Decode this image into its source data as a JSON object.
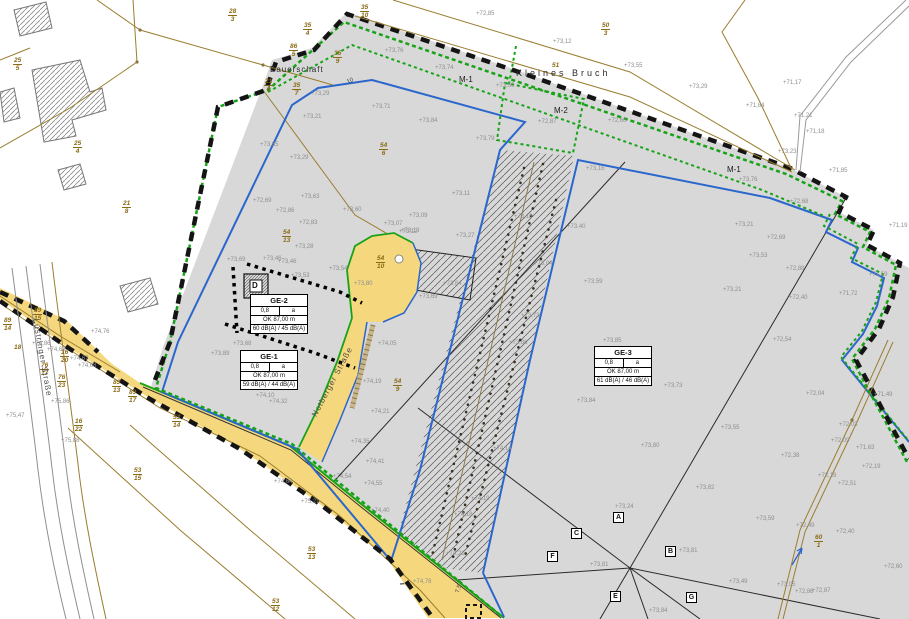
{
  "map": {
    "area_labels": [
      {
        "n": "kleines-bruch-label",
        "t": "Kleines Bruch",
        "x": 516,
        "y": 68,
        "cls": "area-label"
      },
      {
        "n": "bauerschaft-label",
        "t": "Bauerschaft",
        "x": 270,
        "y": 65,
        "cls": "area-label2"
      }
    ],
    "m_labels": [
      {
        "n": "m1-label-a",
        "t": "M-1",
        "x": 459,
        "y": 75
      },
      {
        "n": "m1-label-b",
        "t": "M-1",
        "x": 727,
        "y": 165
      },
      {
        "n": "m2-label",
        "t": "M-2",
        "x": 554,
        "y": 106
      }
    ],
    "streets": [
      {
        "n": "street-luestringer-strasse",
        "t": "Lüstringer Straße",
        "x": 40,
        "y": 318,
        "rot": 80
      },
      {
        "n": "street-notberger-strasse",
        "t": "Notberger Straße",
        "x": 310,
        "y": 414,
        "rot": -62
      }
    ],
    "zone_boxes": [
      {
        "id": "GE-2",
        "grz": "0,8",
        "bw": "a",
        "ok": "OK 87,00 m",
        "db": "60 dB(A) / 45 dB(A)",
        "x": 250,
        "y": 294
      },
      {
        "id": "GE-1",
        "grz": "0,8",
        "bw": "a",
        "ok": "OK 87,00 m",
        "db": "59 dB(A) / 44 dB(A)",
        "x": 240,
        "y": 350
      },
      {
        "id": "GE-3",
        "grz": "0,8",
        "bw": "a",
        "ok": "OK 87,00 m",
        "db": "61 dB(A) / 46 dB(A)",
        "x": 594,
        "y": 346
      }
    ],
    "d_marker": {
      "t": "D",
      "x": 252,
      "y": 281
    },
    "section_markers": [
      {
        "t": "A",
        "x": 613,
        "y": 512
      },
      {
        "t": "C",
        "x": 571,
        "y": 528
      },
      {
        "t": "F",
        "x": 547,
        "y": 551
      },
      {
        "t": "B",
        "x": 665,
        "y": 546
      },
      {
        "t": "E",
        "x": 610,
        "y": 591
      },
      {
        "t": "G",
        "x": 686,
        "y": 592
      }
    ],
    "dimensions": [
      {
        "n": "dim-7-5",
        "t": "7,5",
        "x": 455,
        "y": 592,
        "rot": -72
      },
      {
        "n": "dim-10",
        "t": "10",
        "x": 346,
        "y": 80,
        "rot": -25
      }
    ],
    "parcels": [
      {
        "num": "28",
        "den": "3",
        "x": 228,
        "y": 8
      },
      {
        "num": "35",
        "den": "4",
        "x": 303,
        "y": 22
      },
      {
        "num": "86",
        "den": "5",
        "x": 289,
        "y": 43
      },
      {
        "num": "25",
        "den": "5",
        "x": 13,
        "y": 57
      },
      {
        "num": "21",
        "den": "6",
        "x": 264,
        "y": 78
      },
      {
        "num": "35",
        "den": "7",
        "x": 292,
        "y": 82
      },
      {
        "num": "35",
        "den": "9",
        "x": 333,
        "y": 50
      },
      {
        "num": "35",
        "den": "10",
        "x": 360,
        "y": 4
      },
      {
        "num": "50",
        "den": "3",
        "x": 601,
        "y": 22
      },
      {
        "num": "25",
        "den": "4",
        "x": 73,
        "y": 140
      },
      {
        "num": "21",
        "den": "8",
        "x": 122,
        "y": 200
      },
      {
        "num": "54",
        "den": "6",
        "x": 379,
        "y": 142
      },
      {
        "num": "54",
        "den": "13",
        "x": 282,
        "y": 229
      },
      {
        "num": "54",
        "den": "10",
        "x": 376,
        "y": 255
      },
      {
        "num": "54",
        "den": "9",
        "x": 393,
        "y": 378
      },
      {
        "num": "54",
        "den": "11",
        "x": 609,
        "y": 370
      },
      {
        "num": "89",
        "den": "15",
        "x": 33,
        "y": 307
      },
      {
        "num": "89",
        "den": "14",
        "x": 3,
        "y": 317
      },
      {
        "num": "76",
        "den": "17",
        "x": 40,
        "y": 362
      },
      {
        "num": "76",
        "den": "23",
        "x": 57,
        "y": 374
      },
      {
        "num": "16",
        "den": "20",
        "x": 60,
        "y": 349
      },
      {
        "num": "16",
        "den": "22",
        "x": 74,
        "y": 418
      },
      {
        "num": "89",
        "den": "13",
        "x": 112,
        "y": 379
      },
      {
        "num": "89",
        "den": "17",
        "x": 128,
        "y": 389
      },
      {
        "num": "53",
        "den": "14",
        "x": 172,
        "y": 414
      },
      {
        "num": "53",
        "den": "15",
        "x": 133,
        "y": 467
      },
      {
        "num": "53",
        "den": "13",
        "x": 307,
        "y": 546
      },
      {
        "num": "53",
        "den": "12",
        "x": 271,
        "y": 598
      },
      {
        "num": "60",
        "den": "1",
        "x": 814,
        "y": 534
      }
    ],
    "parcels_single": [
      {
        "t": "51",
        "x": 552,
        "y": 62
      },
      {
        "t": "18",
        "x": 14,
        "y": 344
      }
    ],
    "elevations": [
      {
        "t": "+72,85",
        "x": 476,
        "y": 11
      },
      {
        "t": "+73,12",
        "x": 553,
        "y": 39
      },
      {
        "t": "+73,76",
        "x": 385,
        "y": 48
      },
      {
        "t": "+73,74",
        "x": 435,
        "y": 65
      },
      {
        "t": "+73,60",
        "x": 496,
        "y": 83
      },
      {
        "t": "+73,71",
        "x": 372,
        "y": 104
      },
      {
        "t": "+73,84",
        "x": 419,
        "y": 118
      },
      {
        "t": "+73,79",
        "x": 476,
        "y": 136
      },
      {
        "t": "+73,29",
        "x": 311,
        "y": 91
      },
      {
        "t": "+73,21",
        "x": 303,
        "y": 114
      },
      {
        "t": "+72,60",
        "x": 608,
        "y": 118
      },
      {
        "t": "+72,87",
        "x": 538,
        "y": 119
      },
      {
        "t": "+73,16",
        "x": 586,
        "y": 166
      },
      {
        "t": "+73,11",
        "x": 452,
        "y": 191
      },
      {
        "t": "+73,27",
        "x": 456,
        "y": 233
      },
      {
        "t": "+73,40",
        "x": 567,
        "y": 224
      },
      {
        "t": "+73,09",
        "x": 409,
        "y": 213
      },
      {
        "t": "+73,13",
        "x": 401,
        "y": 228
      },
      {
        "t": "+73,18",
        "x": 514,
        "y": 214
      },
      {
        "t": "+73,59",
        "x": 584,
        "y": 279
      },
      {
        "t": "+73,04",
        "x": 534,
        "y": 261
      },
      {
        "t": "+73,84",
        "x": 443,
        "y": 281
      },
      {
        "t": "+73,69",
        "x": 419,
        "y": 294
      },
      {
        "t": "+73,73",
        "x": 521,
        "y": 313
      },
      {
        "t": "+73,86",
        "x": 509,
        "y": 340
      },
      {
        "t": "+73,63",
        "x": 301,
        "y": 194
      },
      {
        "t": "+72,86",
        "x": 276,
        "y": 208
      },
      {
        "t": "+73,60",
        "x": 343,
        "y": 207
      },
      {
        "t": "+72,83",
        "x": 299,
        "y": 220
      },
      {
        "t": "+73,07",
        "x": 384,
        "y": 221
      },
      {
        "t": "+73,12",
        "x": 399,
        "y": 229
      },
      {
        "t": "+73,28",
        "x": 295,
        "y": 244
      },
      {
        "t": "+73,46",
        "x": 278,
        "y": 259
      },
      {
        "t": "+73,53",
        "x": 291,
        "y": 273
      },
      {
        "t": "+73,54",
        "x": 329,
        "y": 266
      },
      {
        "t": "+73,80",
        "x": 354,
        "y": 281
      },
      {
        "t": "+73,69",
        "x": 227,
        "y": 257
      },
      {
        "t": "+73,46",
        "x": 263,
        "y": 256
      },
      {
        "t": "+73,68",
        "x": 233,
        "y": 341
      },
      {
        "t": "+73,89",
        "x": 211,
        "y": 351
      },
      {
        "t": "+74,10",
        "x": 256,
        "y": 393
      },
      {
        "t": "+74,32",
        "x": 269,
        "y": 399
      },
      {
        "t": "+74,19",
        "x": 363,
        "y": 379
      },
      {
        "t": "+74,05",
        "x": 378,
        "y": 341
      },
      {
        "t": "+74,21",
        "x": 371,
        "y": 409
      },
      {
        "t": "+74,35",
        "x": 351,
        "y": 439
      },
      {
        "t": "+74,41",
        "x": 366,
        "y": 459
      },
      {
        "t": "+74,54",
        "x": 333,
        "y": 474
      },
      {
        "t": "+74,55",
        "x": 364,
        "y": 481
      },
      {
        "t": "+74,64",
        "x": 274,
        "y": 479
      },
      {
        "t": "+74,40",
        "x": 371,
        "y": 508
      },
      {
        "t": "+74,19",
        "x": 471,
        "y": 496
      },
      {
        "t": "+74,18",
        "x": 454,
        "y": 512
      },
      {
        "t": "+74,21",
        "x": 446,
        "y": 551
      },
      {
        "t": "+74,14",
        "x": 493,
        "y": 446
      },
      {
        "t": "+74,78",
        "x": 413,
        "y": 579
      },
      {
        "t": "+75,21",
        "x": 301,
        "y": 499
      },
      {
        "t": "+74,76",
        "x": 91,
        "y": 329
      },
      {
        "t": "+74,86",
        "x": 32,
        "y": 341
      },
      {
        "t": "+74,69",
        "x": 47,
        "y": 347
      },
      {
        "t": "+74,67",
        "x": 70,
        "y": 356
      },
      {
        "t": "+74,68",
        "x": 78,
        "y": 363
      },
      {
        "t": "+75,47",
        "x": 6,
        "y": 413
      },
      {
        "t": "+75,86",
        "x": 51,
        "y": 399
      },
      {
        "t": "+75,88",
        "x": 61,
        "y": 438
      },
      {
        "t": "+73,23",
        "x": 778,
        "y": 149
      },
      {
        "t": "+71,85",
        "x": 829,
        "y": 168
      },
      {
        "t": "+73,76",
        "x": 739,
        "y": 177
      },
      {
        "t": "+72,68",
        "x": 790,
        "y": 199
      },
      {
        "t": "+71,19",
        "x": 889,
        "y": 223
      },
      {
        "t": "+73,21",
        "x": 735,
        "y": 222
      },
      {
        "t": "+72,69",
        "x": 767,
        "y": 235
      },
      {
        "t": "+73,53",
        "x": 749,
        "y": 253
      },
      {
        "t": "+72,88",
        "x": 786,
        "y": 266
      },
      {
        "t": "+73,21",
        "x": 723,
        "y": 287
      },
      {
        "t": "+72,40",
        "x": 789,
        "y": 295
      },
      {
        "t": "+71,72",
        "x": 839,
        "y": 291
      },
      {
        "t": "+71,59",
        "x": 869,
        "y": 272
      },
      {
        "t": "+72,54",
        "x": 773,
        "y": 337
      },
      {
        "t": "+73,55",
        "x": 624,
        "y": 63
      },
      {
        "t": "+73,29",
        "x": 689,
        "y": 84
      },
      {
        "t": "+71,84",
        "x": 746,
        "y": 103
      },
      {
        "t": "+71,17",
        "x": 783,
        "y": 80
      },
      {
        "t": "+71,21",
        "x": 794,
        "y": 113
      },
      {
        "t": "+71,18",
        "x": 806,
        "y": 129
      },
      {
        "t": "+72,04",
        "x": 806,
        "y": 391
      },
      {
        "t": "+71,49",
        "x": 874,
        "y": 392
      },
      {
        "t": "+72,03",
        "x": 839,
        "y": 422
      },
      {
        "t": "+72,09",
        "x": 831,
        "y": 438
      },
      {
        "t": "+71,63",
        "x": 856,
        "y": 445
      },
      {
        "t": "+72,38",
        "x": 781,
        "y": 453
      },
      {
        "t": "+72,18",
        "x": 818,
        "y": 473
      },
      {
        "t": "+72,19",
        "x": 862,
        "y": 464
      },
      {
        "t": "+72,51",
        "x": 838,
        "y": 481
      },
      {
        "t": "+72,49",
        "x": 796,
        "y": 523
      },
      {
        "t": "+72,40",
        "x": 836,
        "y": 529
      },
      {
        "t": "+72,60",
        "x": 884,
        "y": 564
      },
      {
        "t": "+72,86",
        "x": 795,
        "y": 589
      },
      {
        "t": "+72,87",
        "x": 812,
        "y": 588
      },
      {
        "t": "+73,05",
        "x": 777,
        "y": 582
      },
      {
        "t": "+73,24",
        "x": 615,
        "y": 504
      },
      {
        "t": "+73,82",
        "x": 696,
        "y": 485
      },
      {
        "t": "+73,59",
        "x": 756,
        "y": 516
      },
      {
        "t": "+73,81",
        "x": 679,
        "y": 548
      },
      {
        "t": "+73,81",
        "x": 590,
        "y": 562
      },
      {
        "t": "+73,49",
        "x": 729,
        "y": 579
      },
      {
        "t": "+73,84",
        "x": 649,
        "y": 608
      },
      {
        "t": "+73,85",
        "x": 603,
        "y": 338
      },
      {
        "t": "+73,73",
        "x": 664,
        "y": 383
      },
      {
        "t": "+73,84",
        "x": 577,
        "y": 398
      },
      {
        "t": "+73,55",
        "x": 721,
        "y": 425
      },
      {
        "t": "+73,80",
        "x": 641,
        "y": 443
      },
      {
        "t": "+73,35",
        "x": 260,
        "y": 142
      },
      {
        "t": "+73,29",
        "x": 290,
        "y": 155
      },
      {
        "t": "+72,69",
        "x": 253,
        "y": 198
      }
    ],
    "colors": {
      "plan_fill": "#d8d8d8",
      "road_yellow": "#f5d87d",
      "green_line": "#17a317",
      "blue_line": "#2a66cc",
      "parcel_brown": "#8a6a15",
      "boundary_black": "#141414"
    }
  }
}
